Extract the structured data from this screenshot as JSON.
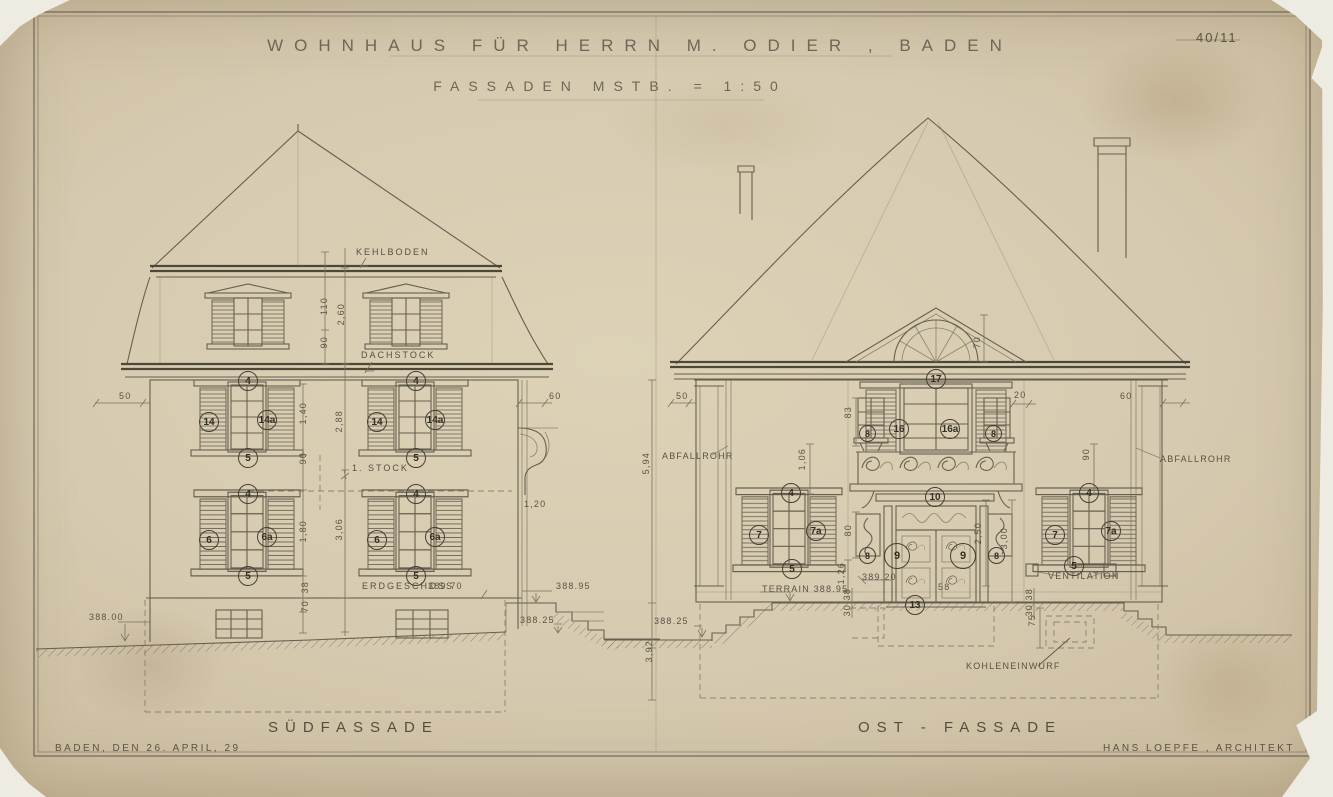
{
  "sheet": {
    "title_line1": "WOHNHAUS FÜR HERRN M. ODIER , BADEN",
    "title_line2": "FASSADEN MSTB. = 1:50",
    "sheet_number": "40/11",
    "date_note": "BADEN, DEN 26. APRIL, 29",
    "architect_note": "HANS LOEPFE , ARCHITEKT"
  },
  "south_facade": {
    "label": "SÜDFASSADE",
    "levels": {
      "kehlboden": "KEHLBODEN",
      "dachstock": "DACHSTOCK",
      "stock1": "1. STOCK",
      "erdgeschoss": "ERDGESCHOSS",
      "erdgeschoss_elev": "389.70"
    },
    "window_tags": {
      "n4": "4",
      "n5": "5",
      "n6": "6",
      "n6a": "6a",
      "n14": "14",
      "n14a": "14a"
    },
    "dims": {
      "d50": "50",
      "d60": "60",
      "d110": "110",
      "d90": "90",
      "d260": "2,60",
      "d288": "2,88",
      "d140": "1,40",
      "d306": "3,06",
      "d180": "1,80",
      "d38": "38",
      "d70": "70",
      "d120": "1,20"
    },
    "elevations": {
      "e388_00": "388.00",
      "e388_95": "388.95",
      "e388_25": "388.25"
    }
  },
  "east_facade": {
    "label": "OST - FASSADE",
    "labels": {
      "abfallrohr": "ABFALLROHR",
      "terrain": "TERRAIN 388.95",
      "ventilation": "VENTILATION",
      "kohleneinwurf": "KOHLENEINWURF"
    },
    "window_tags": {
      "n4": "4",
      "n5": "5",
      "n7": "7",
      "n7a": "7a",
      "n8": "8",
      "n9": "9",
      "n10": "10",
      "n13": "13",
      "n16": "16",
      "n16a": "16a",
      "n17": "17"
    },
    "dims": {
      "d50": "50",
      "d60": "60",
      "d20": "20",
      "d58": "58",
      "d70": "70",
      "d594": "5,94",
      "d392": "3,92",
      "d83": "83",
      "d80": "80",
      "d126": "1,26",
      "d106": "1,06",
      "d90": "90",
      "d250": "2,50",
      "d300": "3,00",
      "d75": "75",
      "d30": "30",
      "d38": "38"
    },
    "elevations": {
      "e389_20": "389.20",
      "e388_25": "388.25"
    }
  }
}
